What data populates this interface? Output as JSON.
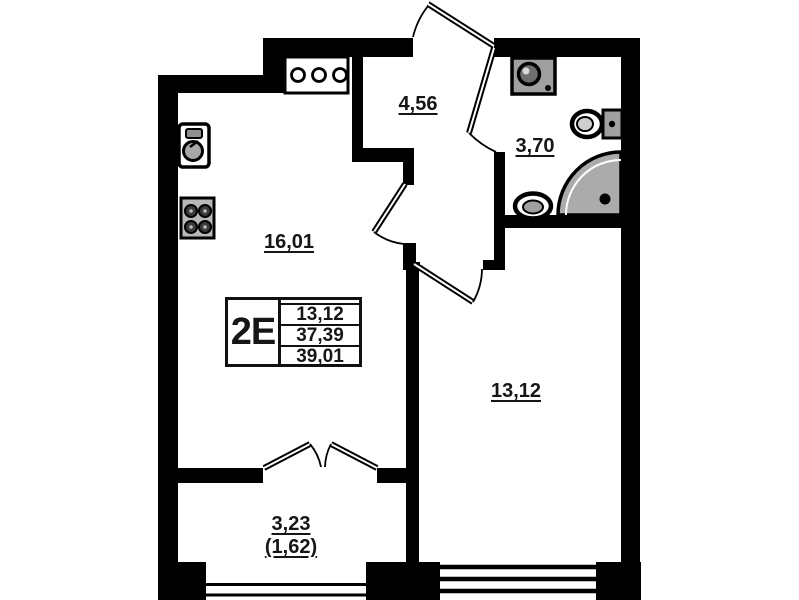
{
  "plan": {
    "unit_label": "2E",
    "info_box": {
      "living_room_area": "13,12",
      "apartment_area": "37,39",
      "total_area": "39,01"
    },
    "rooms": {
      "kitchen_living": "16,01",
      "hallway": "4,56",
      "bathroom": "3,70",
      "bedroom": "13,12",
      "balcony": "3,23",
      "balcony_reduced": "(1,62)"
    },
    "colors": {
      "wall": "#000000",
      "fixture_gray": "#a8a8a8",
      "background": "#ffffff"
    }
  }
}
